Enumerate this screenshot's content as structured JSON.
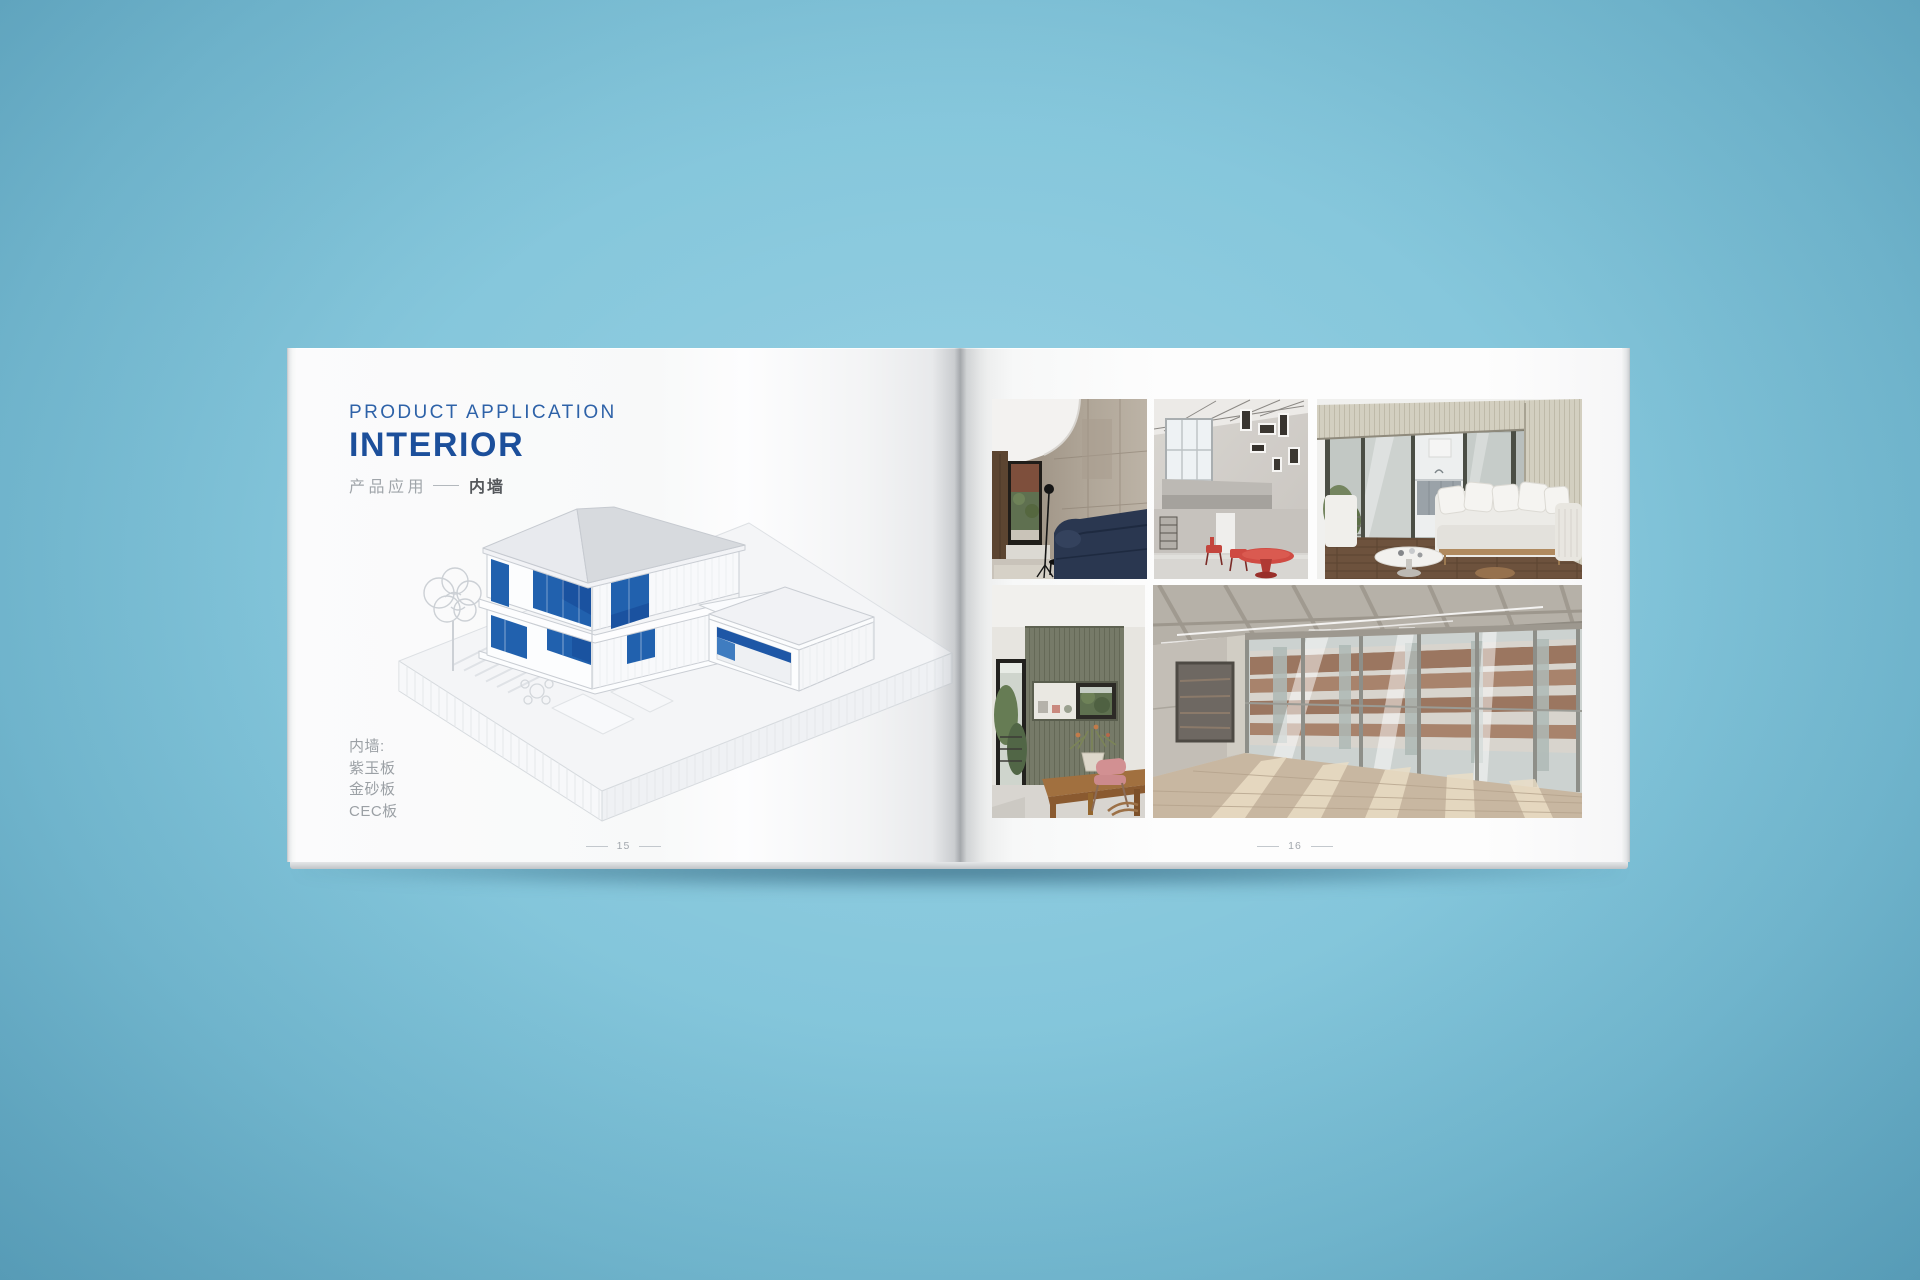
{
  "colors": {
    "background_blue": "#84c6db",
    "title_blue": "#1c4f9b",
    "eyebrow_blue": "#2e62a8",
    "house_panel_blue": "#2161ae",
    "muted_text_gray": "#9ba0a5",
    "dark_text_gray": "#55585c"
  },
  "left_page": {
    "eyebrow": "PRODUCT APPLICATION",
    "title": "INTERIOR",
    "subtitle": "产品应用",
    "subtitle_highlight": "内墙",
    "materials_heading": "内墙:",
    "materials": [
      "紫玉板",
      "金砂板",
      "CEC板"
    ],
    "page_number": "15",
    "illustration": "isometric-house-cutaway"
  },
  "right_page": {
    "page_number": "16",
    "photos": [
      {
        "name": "concrete-living-room-navy-sofa"
      },
      {
        "name": "double-height-white-loft-red-table"
      },
      {
        "name": "terrace-lounge-white-sofa-kitchen"
      },
      {
        "name": "dining-nook-wood-panel-pink-chair"
      },
      {
        "name": "empty-concrete-hall-glazed-wall"
      }
    ]
  }
}
